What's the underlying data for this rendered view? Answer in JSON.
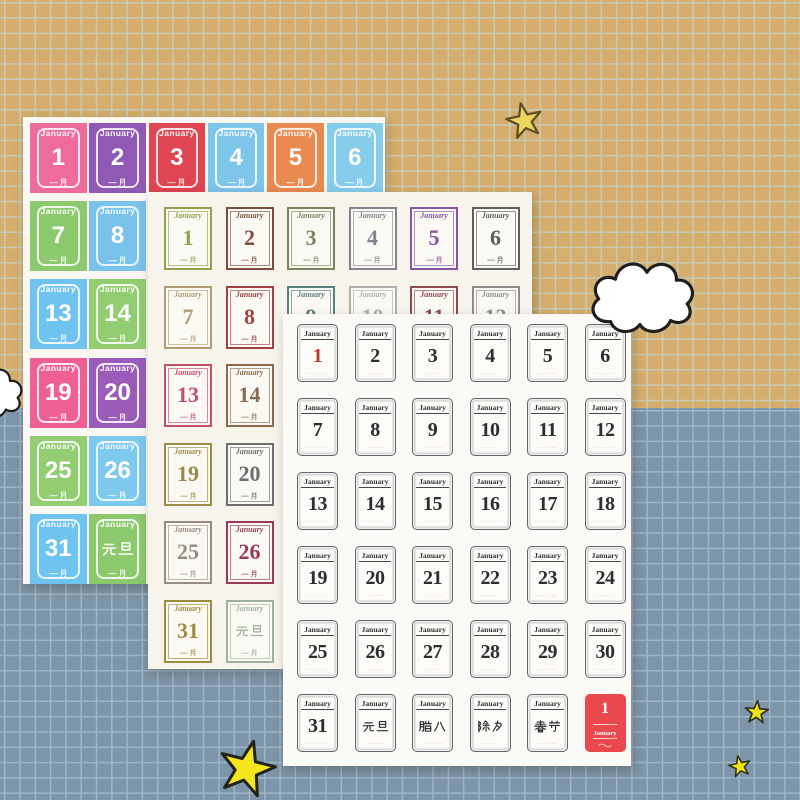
{
  "background": {
    "top_color": "#d5ad6c",
    "top_grid_line": "#c7ccb8",
    "bottom_color": "#7d95a8",
    "bottom_grid_line": "#a0b5c6"
  },
  "decorations": {
    "cloud_fill": "#ffffff",
    "cloud_outline": "#1e1e1c",
    "clouds": [
      {
        "name": "cloud-main"
      },
      {
        "name": "cloud-left-edge"
      }
    ],
    "stars": [
      {
        "name": "star-top",
        "fill": "#ebd55c",
        "outline": "#5d4f26"
      },
      {
        "name": "star-big-bottom",
        "fill": "#f4e61c",
        "outline": "#23231a"
      },
      {
        "name": "star-small-right-upper",
        "fill": "#f2e414",
        "outline": "#33331f"
      },
      {
        "name": "star-small-right-lower",
        "fill": "#f2e414",
        "outline": "#33331f"
      }
    ]
  },
  "sheets": {
    "back": {
      "month": "January",
      "month_cn": "一月",
      "cells": [
        {
          "day": "1",
          "color": "#ee6b9e"
        },
        {
          "day": "2",
          "color": "#9059b4"
        },
        {
          "day": "3",
          "color": "#e04553"
        },
        {
          "day": "4",
          "color": "#7ec5ea"
        },
        {
          "day": "5",
          "color": "#e98a51"
        },
        {
          "day": "6",
          "color": "#86cdec"
        },
        {
          "day": "7",
          "color": "#8cc96d"
        },
        {
          "day": "8",
          "color": "#79c3ea"
        },
        {
          "day": "9",
          "color": "#ee6b9e"
        },
        {
          "day": "10",
          "color": "#9a5cb8"
        },
        {
          "day": "11",
          "color": "#e04553"
        },
        {
          "day": "12",
          "color": "#e98a51"
        },
        {
          "day": "13",
          "color": "#6ec3ef"
        },
        {
          "day": "14",
          "color": "#92cd72"
        },
        {
          "day": "15",
          "color": "#e98a51"
        },
        {
          "day": "16",
          "color": "#e04553"
        },
        {
          "day": "17",
          "color": "#9a5cb8"
        },
        {
          "day": "18",
          "color": "#ee6b9e"
        },
        {
          "day": "19",
          "color": "#ee5f96"
        },
        {
          "day": "20",
          "color": "#9a5cb8"
        },
        {
          "day": "21",
          "color": "#79c3ea"
        },
        {
          "day": "22",
          "color": "#8cc96d"
        },
        {
          "day": "23",
          "color": "#e98a51"
        },
        {
          "day": "24",
          "color": "#e04553"
        },
        {
          "day": "25",
          "color": "#92cd72"
        },
        {
          "day": "26",
          "color": "#7ec9ee"
        },
        {
          "day": "27",
          "color": "#e04553"
        },
        {
          "day": "28",
          "color": "#ee6b9e"
        },
        {
          "day": "29",
          "color": "#86cdec"
        },
        {
          "day": "30",
          "color": "#e98a51"
        },
        {
          "day": "31",
          "color": "#6ec3ef"
        },
        {
          "day": "元旦",
          "color": "#8cc96d",
          "cjk": true
        },
        {
          "day": "腊八",
          "color": "#ee6b9e",
          "cjk": true
        },
        {
          "day": "除夕",
          "color": "#9a5cb8",
          "cjk": true
        },
        {
          "day": "春节",
          "color": "#e04553",
          "cjk": true
        },
        {
          "day": "1",
          "color": "#e98a51"
        }
      ]
    },
    "middle": {
      "month": "January",
      "month_cn": "一月",
      "cells": [
        {
          "day": "1",
          "color": "#93a04e"
        },
        {
          "day": "2",
          "color": "#7d4c3c"
        },
        {
          "day": "3",
          "color": "#77845e"
        },
        {
          "day": "4",
          "color": "#85818f"
        },
        {
          "day": "5",
          "color": "#8b53a1"
        },
        {
          "day": "6",
          "color": "#5f5f63"
        },
        {
          "day": "7",
          "color": "#b39b72"
        },
        {
          "day": "8",
          "color": "#9e4344"
        },
        {
          "day": "9",
          "color": "#58807e"
        },
        {
          "day": "10",
          "color": "#aeaeae"
        },
        {
          "day": "11",
          "color": "#8f4a4c"
        },
        {
          "day": "12",
          "color": "#8d8d8d"
        },
        {
          "day": "13",
          "color": "#c24e6e"
        },
        {
          "day": "14",
          "color": "#8c6a4e"
        },
        {
          "day": "15",
          "color": "#6a7d8a"
        },
        {
          "day": "16",
          "color": "#8a6a8a"
        },
        {
          "day": "17",
          "color": "#5a6a4a"
        },
        {
          "day": "18",
          "color": "#a06a4a"
        },
        {
          "day": "19",
          "color": "#9c8a4a"
        },
        {
          "day": "20",
          "color": "#6e6e72"
        },
        {
          "day": "21",
          "color": "#7a8a5a"
        },
        {
          "day": "22",
          "color": "#8a5a4a"
        },
        {
          "day": "23",
          "color": "#6a8a8a"
        },
        {
          "day": "24",
          "color": "#9a9a6a"
        },
        {
          "day": "25",
          "color": "#9a8a85"
        },
        {
          "day": "26",
          "color": "#993a5a"
        },
        {
          "day": "27",
          "color": "#8a7a9a"
        },
        {
          "day": "28",
          "color": "#b08a5a"
        },
        {
          "day": "29",
          "color": "#6a6a8a"
        },
        {
          "day": "30",
          "color": "#8a8a4a"
        },
        {
          "day": "31",
          "color": "#9d8b3f"
        },
        {
          "day": "元旦",
          "color": "#9fb0a0",
          "cjk": true
        },
        {
          "day": "腊八",
          "color": "#8a8a8a",
          "cjk": true
        },
        {
          "day": "除夕",
          "color": "#9a6a5a",
          "cjk": true
        },
        {
          "day": "春节",
          "color": "#a04a4a",
          "cjk": true
        },
        {
          "day": "1",
          "color": "#c0504e"
        }
      ]
    },
    "front": {
      "month": "January",
      "ink": "#2e2e32",
      "red_ink": "#c0392b",
      "red_stamp_color": "#e8484e",
      "fine_print_gray": "·····",
      "fine_print_red": "··",
      "cells": [
        {
          "day": "1",
          "red_num": true
        },
        {
          "day": "2"
        },
        {
          "day": "3"
        },
        {
          "day": "4"
        },
        {
          "day": "5"
        },
        {
          "day": "6"
        },
        {
          "day": "7"
        },
        {
          "day": "8"
        },
        {
          "day": "9"
        },
        {
          "day": "10"
        },
        {
          "day": "11"
        },
        {
          "day": "12"
        },
        {
          "day": "13"
        },
        {
          "day": "14"
        },
        {
          "day": "15"
        },
        {
          "day": "16"
        },
        {
          "day": "17"
        },
        {
          "day": "18"
        },
        {
          "day": "19"
        },
        {
          "day": "20"
        },
        {
          "day": "21"
        },
        {
          "day": "22"
        },
        {
          "day": "23"
        },
        {
          "day": "24"
        },
        {
          "day": "25"
        },
        {
          "day": "26"
        },
        {
          "day": "27"
        },
        {
          "day": "28"
        },
        {
          "day": "29"
        },
        {
          "day": "30"
        },
        {
          "day": "31"
        },
        {
          "day": "元旦",
          "cjk": true
        },
        {
          "day": "腊八",
          "cjk": true
        },
        {
          "day": "除夕",
          "cjk": true
        },
        {
          "day": "春节",
          "cjk": true
        },
        {
          "day": "1",
          "filled": true
        }
      ]
    }
  }
}
